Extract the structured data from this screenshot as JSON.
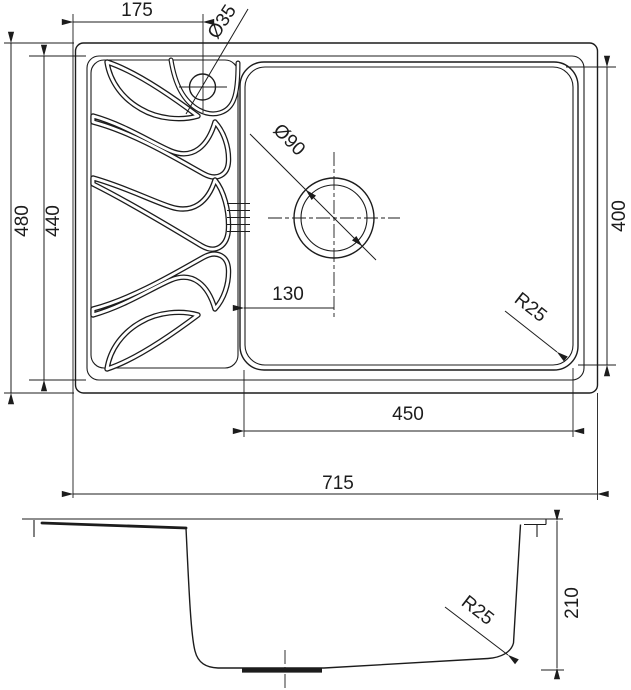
{
  "drawing": {
    "ink_color": "#1c1c1c",
    "background_color": "#ffffff",
    "top_view": {
      "dimensions": {
        "tap_hole_offset": "175",
        "tap_hole_diameter": "Ø35",
        "overall_depth": "480",
        "basin_area_depth": "440",
        "drain_diameter": "Ø90",
        "bowl_inner_depth": "400",
        "drain_offset_from_bowl_edge": "130",
        "bowl_corner_radius": "R25",
        "bowl_inner_width": "450",
        "overall_width": "715"
      }
    },
    "side_view": {
      "dimensions": {
        "bottom_corner_radius": "R25",
        "bowl_height": "210"
      }
    }
  }
}
